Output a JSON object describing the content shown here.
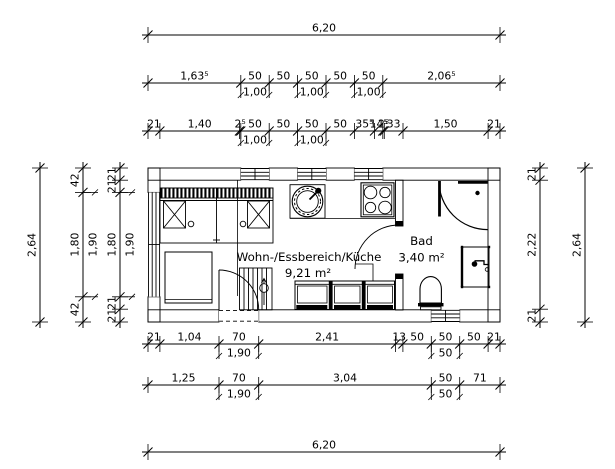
{
  "drawing": {
    "type": "floor-plan",
    "units_note": "dimensions in meters/centimeters as drawn"
  },
  "rooms": [
    {
      "name": "Wohn-/Essbereich/Küche",
      "area": "9,21 m²"
    },
    {
      "name": "Bad",
      "area": "3,40 m²"
    }
  ],
  "dimensions": [
    {
      "id": "top-overall",
      "orientation": "horizontal",
      "line": 35,
      "bounds": [
        148,
        500
      ],
      "labels": [
        "6,20"
      ],
      "subs": []
    },
    {
      "id": "top-openings",
      "orientation": "horizontal",
      "line": 83,
      "bounds": [
        148,
        240.8,
        269.2,
        297.6,
        326,
        354.4,
        382.8,
        500
      ],
      "labels": [
        "1,63⁵",
        "50",
        "50",
        "50",
        "50",
        "50",
        "2,06⁵"
      ],
      "subs": [
        {
          "text": "1,00",
          "seg": 1
        },
        {
          "text": "1,00",
          "seg": 3
        },
        {
          "text": "1,00",
          "seg": 5
        }
      ]
    },
    {
      "id": "top-detail",
      "orientation": "horizontal",
      "line": 131,
      "bounds": [
        148,
        159.9,
        239.4,
        240.8,
        269.2,
        297.6,
        326,
        354.4,
        374.5,
        382.8,
        384.3,
        403,
        488.1,
        500
      ],
      "labels": [
        "21",
        "1,40",
        "2⁵",
        "50",
        "50",
        "50",
        "50",
        "35⁵",
        "14⁵",
        "2⁵",
        "33",
        "1,50",
        "21"
      ],
      "subs": [
        {
          "text": "1,00",
          "seg": 3
        },
        {
          "text": "1,00",
          "seg": 5
        }
      ]
    },
    {
      "id": "bottom-detail",
      "orientation": "horizontal",
      "line": 344,
      "bounds": [
        148,
        159.9,
        219,
        258.7,
        395.5,
        402.9,
        431.3,
        459.7,
        488.1,
        500
      ],
      "labels": [
        "21",
        "1,04",
        "70",
        "2,41",
        "13",
        "50",
        "50",
        "50",
        "21"
      ],
      "subs": [
        {
          "text": "1,90",
          "seg": 2
        },
        {
          "text": "50",
          "seg": 6
        }
      ]
    },
    {
      "id": "bottom-openings",
      "orientation": "horizontal",
      "line": 385,
      "bounds": [
        148,
        219,
        258.7,
        431.3,
        459.7,
        500
      ],
      "labels": [
        "1,25",
        "70",
        "3,04",
        "50",
        "71"
      ],
      "subs": [
        {
          "text": "1,90",
          "seg": 1
        },
        {
          "text": "50",
          "seg": 3
        }
      ]
    },
    {
      "id": "bottom-overall",
      "orientation": "horizontal",
      "line": 452,
      "bounds": [
        148,
        500
      ],
      "labels": [
        "6,20"
      ],
      "subs": []
    },
    {
      "id": "left-overall",
      "orientation": "vertical",
      "line": 40,
      "bounds": [
        168,
        322
      ],
      "labels": [
        "2,64"
      ],
      "subs": []
    },
    {
      "id": "left-opening",
      "orientation": "vertical",
      "line": 83,
      "bounds": [
        168,
        192.4,
        296.8,
        322
      ],
      "labels": [
        "42",
        "1,80",
        "42"
      ],
      "subs": [
        {
          "text": "1,90",
          "seg": 1
        }
      ]
    },
    {
      "id": "left-detail",
      "orientation": "vertical",
      "line": 120,
      "bounds": [
        168,
        180.2,
        192.4,
        296.8,
        309.2,
        322
      ],
      "labels": [
        "21",
        "21",
        "1,80",
        "21",
        "21"
      ],
      "subs": [
        {
          "text": "1,90",
          "seg": 2
        }
      ]
    },
    {
      "id": "right-detail",
      "orientation": "vertical",
      "line": 540,
      "bounds": [
        168,
        180.2,
        309.2,
        322
      ],
      "labels": [
        "21",
        "2,22",
        "21"
      ],
      "subs": []
    },
    {
      "id": "right-overall",
      "orientation": "vertical",
      "line": 585,
      "bounds": [
        168,
        322
      ],
      "labels": [
        "2,64"
      ],
      "subs": []
    }
  ]
}
